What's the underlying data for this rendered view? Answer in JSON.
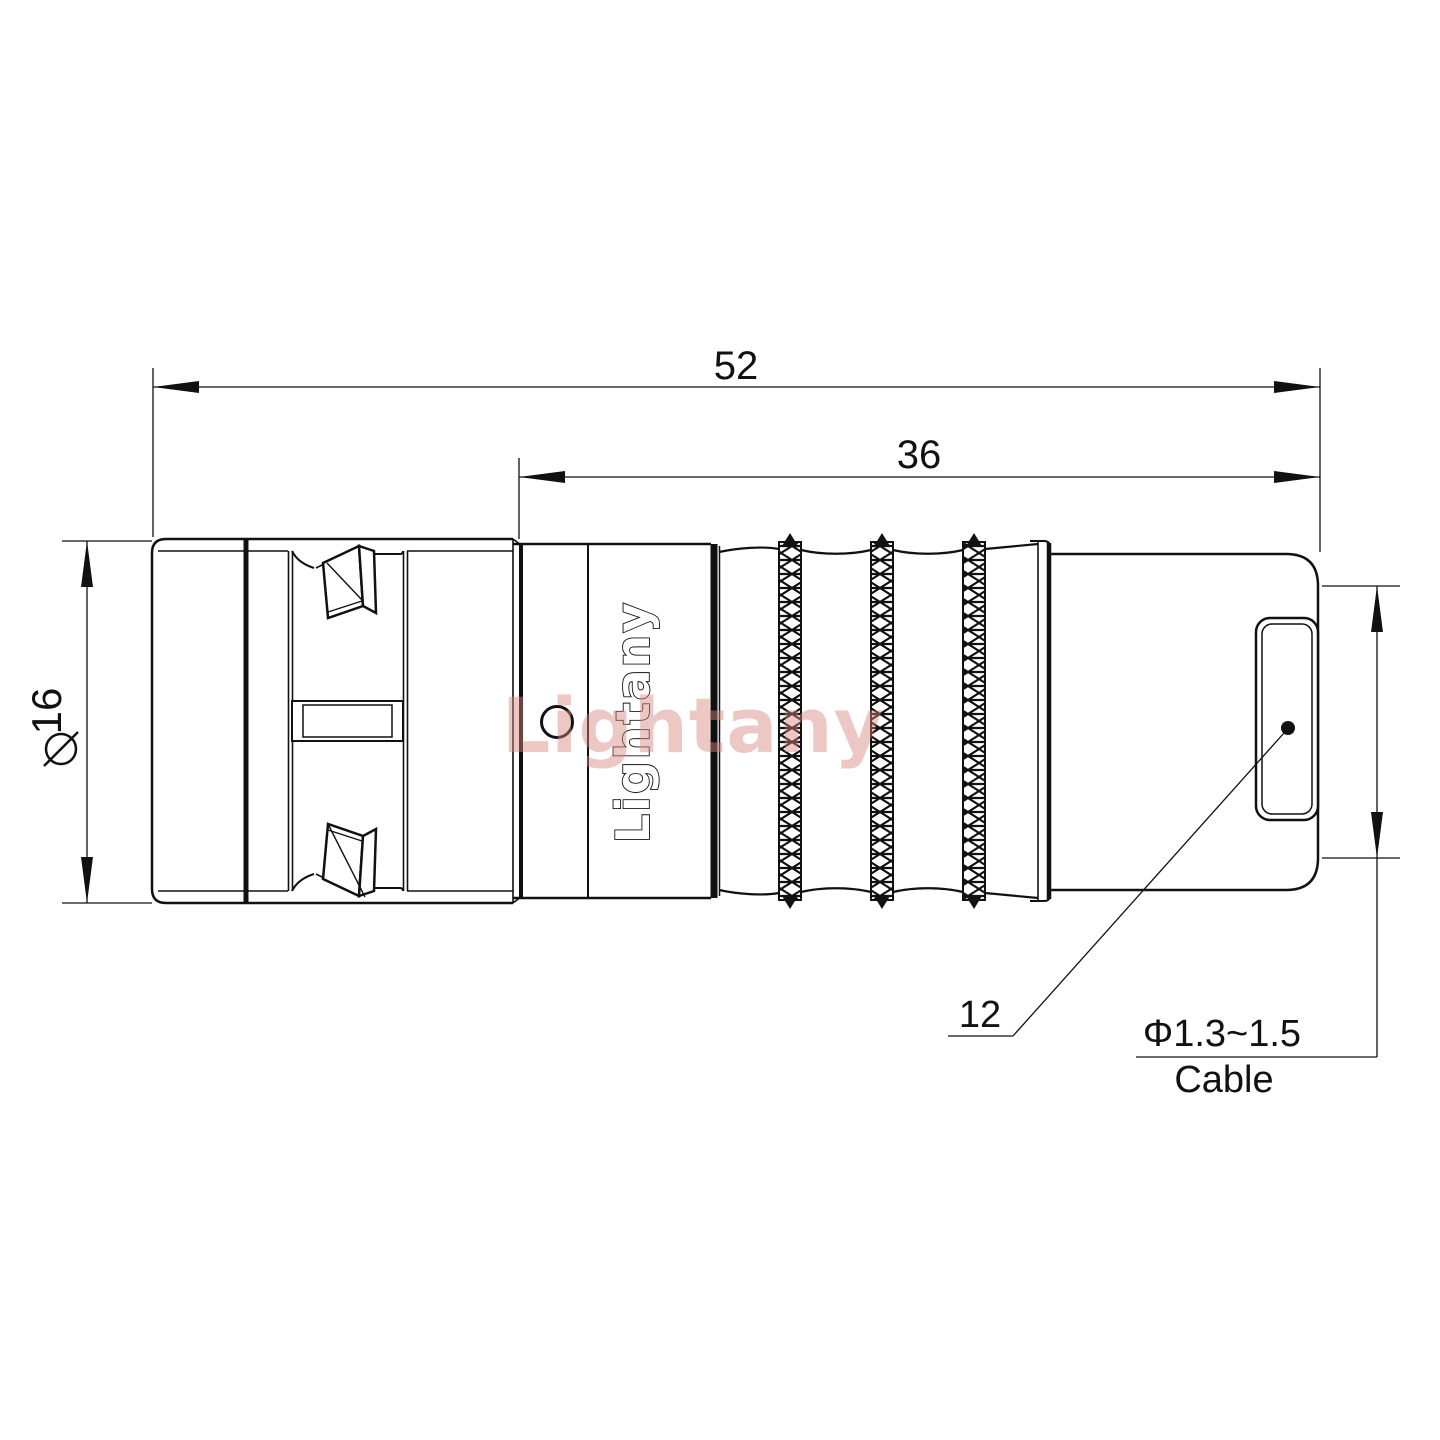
{
  "colors": {
    "line": "#111111",
    "watermark": "#d9857c",
    "background": "#ffffff"
  },
  "dimensions": {
    "total_length": {
      "value": "52"
    },
    "body_length": {
      "value": "36"
    },
    "front_diameter": {
      "label": "∕16",
      "value": "16"
    },
    "rear_face": {
      "value": "12"
    },
    "cable": {
      "diameter_range": "Φ1.3~1.5",
      "label": "Cable"
    }
  },
  "branding": {
    "engraving": "Lightany",
    "watermark": "Lightany"
  }
}
